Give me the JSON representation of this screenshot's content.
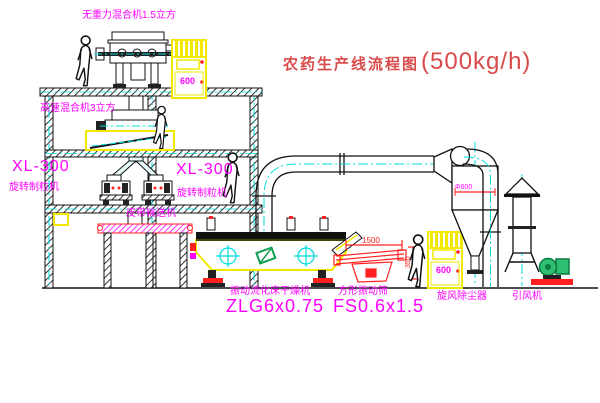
{
  "title": {
    "zh": "农药生产线流程图",
    "capacity": "(500kg/h)"
  },
  "labels": {
    "gravity_mixer": "无重力混合机1.5立方",
    "high_speed_mixer": "高速混合机3立方",
    "granulator_left_model": "XL-300",
    "granulator_left_name": "旋转制粒机",
    "granulator_right_model": "XL-300",
    "granulator_right_name": "旋转制粒机",
    "belt_conveyor": "皮带输送机",
    "dryer_name": "振动流化床干燥机",
    "dryer_model": "ZLG6x0.75",
    "sieve_name": "方形振动筛",
    "sieve_model": "FS0.6x1.5",
    "cyclone": "旋风除尘器",
    "fan": "引风机"
  },
  "dimensions": {
    "sieve_width": "1500",
    "sieve_side": "350",
    "cyclone_dia": "Φ600"
  },
  "cabinets": {
    "display": "600"
  },
  "colors": {
    "line": "#111111",
    "centerline_cyan": "#00dcdc",
    "equipment_yellow": "#f2e800",
    "accent_red": "#ff2020",
    "label_magenta": "#ff00ff",
    "title_red": "#d94b4b",
    "fan_green": "#2fbf71"
  }
}
